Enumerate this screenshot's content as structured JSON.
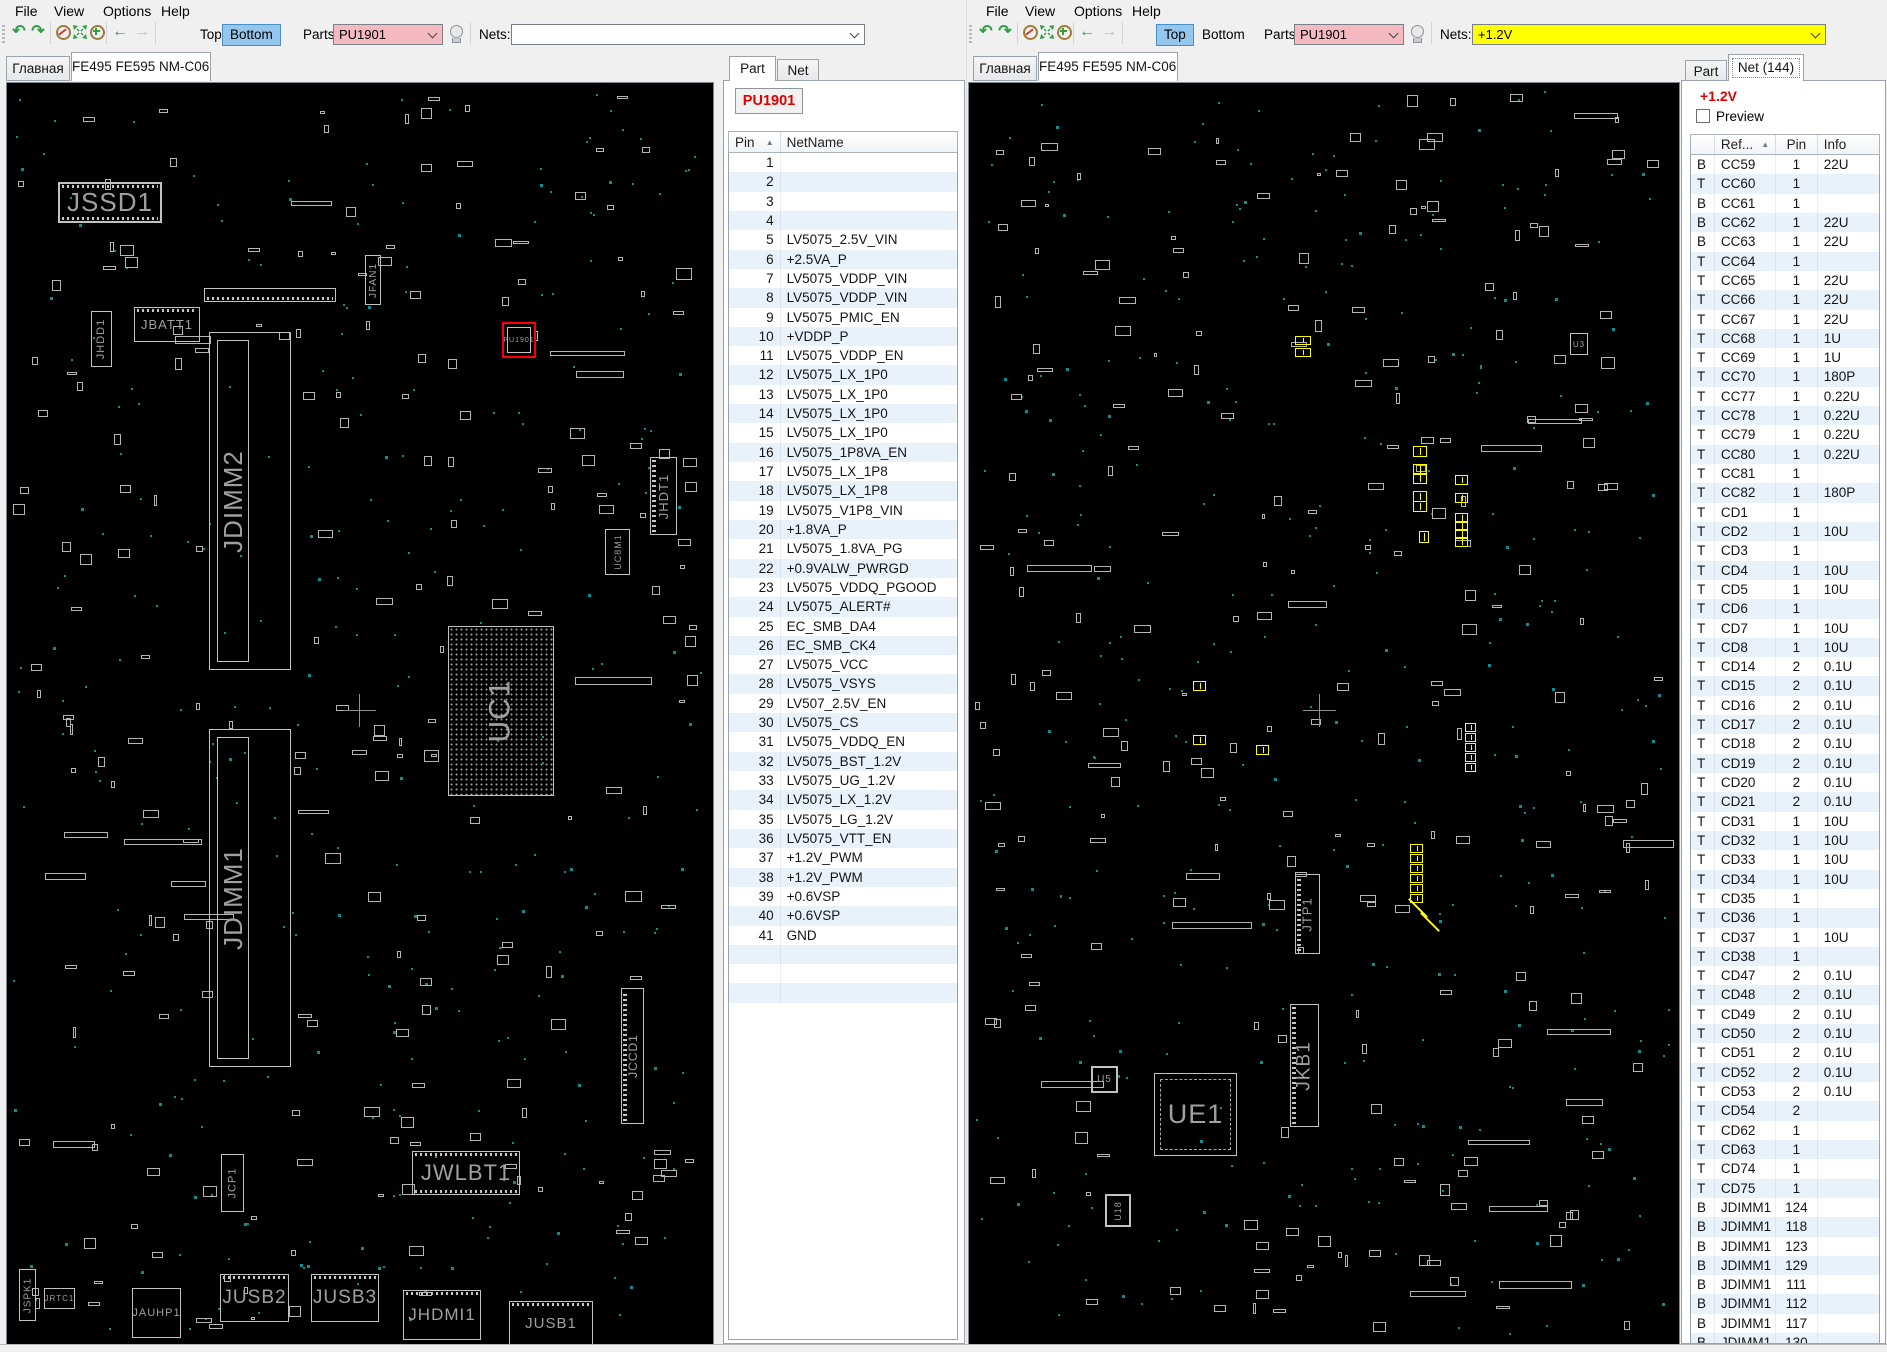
{
  "colors": {
    "selection_blue": "#95c6ee",
    "parts_pink": "#f5b9c2",
    "nets_yellow": "#ffff00",
    "net_red": "#e00000",
    "board_teal": "#0c8f8f",
    "highlight_red": "#ff0000",
    "row_alt": "#e9f1fb"
  },
  "left_window": {
    "menu": [
      "File",
      "View",
      "Options",
      "Help"
    ],
    "toolbar": {
      "top_label": "Top",
      "bottom_label": "Bottom",
      "active_side": "bottom",
      "parts_label": "Parts:",
      "parts_value": "PU1901",
      "nets_label": "Nets:",
      "nets_value": ""
    },
    "tabs": [
      "Главная",
      "FE495 FE595 NM-C061"
    ]
  },
  "right_window": {
    "menu": [
      "File",
      "View",
      "Options",
      "Help"
    ],
    "toolbar": {
      "top_label": "Top",
      "bottom_label": "Bottom",
      "active_side": "top",
      "parts_label": "Parts:",
      "parts_value": "PU1901",
      "nets_label": "Nets:",
      "nets_value": "+1.2V"
    },
    "tabs": [
      "Главная",
      "FE495 FE595 NM-C061"
    ]
  },
  "part_panel": {
    "tabs": [
      "Part",
      "Net"
    ],
    "active_tab": "Part",
    "part_ref": "PU1901",
    "columns": [
      "Pin",
      "NetName"
    ],
    "rows": [
      {
        "pin": "1",
        "net": ""
      },
      {
        "pin": "2",
        "net": ""
      },
      {
        "pin": "3",
        "net": ""
      },
      {
        "pin": "4",
        "net": ""
      },
      {
        "pin": "5",
        "net": "LV5075_2.5V_VIN"
      },
      {
        "pin": "6",
        "net": "+2.5VA_P"
      },
      {
        "pin": "7",
        "net": "LV5075_VDDP_VIN"
      },
      {
        "pin": "8",
        "net": "LV5075_VDDP_VIN"
      },
      {
        "pin": "9",
        "net": "LV5075_PMIC_EN"
      },
      {
        "pin": "10",
        "net": "+VDDP_P"
      },
      {
        "pin": "11",
        "net": "LV5075_VDDP_EN"
      },
      {
        "pin": "12",
        "net": "LV5075_LX_1P0"
      },
      {
        "pin": "13",
        "net": "LV5075_LX_1P0"
      },
      {
        "pin": "14",
        "net": "LV5075_LX_1P0"
      },
      {
        "pin": "15",
        "net": "LV5075_LX_1P0"
      },
      {
        "pin": "16",
        "net": "LV5075_1P8VA_EN"
      },
      {
        "pin": "17",
        "net": "LV5075_LX_1P8"
      },
      {
        "pin": "18",
        "net": "LV5075_LX_1P8"
      },
      {
        "pin": "19",
        "net": "LV5075_V1P8_VIN"
      },
      {
        "pin": "20",
        "net": "+1.8VA_P"
      },
      {
        "pin": "21",
        "net": "LV5075_1.8VA_PG"
      },
      {
        "pin": "22",
        "net": "+0.9VALW_PWRGD"
      },
      {
        "pin": "23",
        "net": "LV5075_VDDQ_PGOOD"
      },
      {
        "pin": "24",
        "net": "LV5075_ALERT#"
      },
      {
        "pin": "25",
        "net": "EC_SMB_DA4"
      },
      {
        "pin": "26",
        "net": "EC_SMB_CK4"
      },
      {
        "pin": "27",
        "net": "LV5075_VCC"
      },
      {
        "pin": "28",
        "net": "LV5075_VSYS"
      },
      {
        "pin": "29",
        "net": "LV507_2.5V_EN"
      },
      {
        "pin": "30",
        "net": "LV5075_CS"
      },
      {
        "pin": "31",
        "net": "LV5075_VDDQ_EN"
      },
      {
        "pin": "32",
        "net": "LV5075_BST_1.2V"
      },
      {
        "pin": "33",
        "net": "LV5075_UG_1.2V"
      },
      {
        "pin": "34",
        "net": "LV5075_LX_1.2V"
      },
      {
        "pin": "35",
        "net": "LV5075_LG_1.2V"
      },
      {
        "pin": "36",
        "net": "LV5075_VTT_EN"
      },
      {
        "pin": "37",
        "net": "+1.2V_PWM"
      },
      {
        "pin": "38",
        "net": "+1.2V_PWM"
      },
      {
        "pin": "39",
        "net": "+0.6VSP"
      },
      {
        "pin": "40",
        "net": "+0.6VSP"
      },
      {
        "pin": "41",
        "net": "GND"
      }
    ]
  },
  "net_panel": {
    "tabs": [
      "Part",
      "Net (144)"
    ],
    "active_tab": "Net (144)",
    "net_name": "+1.2V",
    "preview_label": "Preview",
    "columns": [
      "",
      "Ref...",
      "Pin",
      "Info"
    ],
    "rows": [
      {
        "side": "B",
        "ref": "CC59",
        "pin": "1",
        "info": "22U"
      },
      {
        "side": "T",
        "ref": "CC60",
        "pin": "1",
        "info": ""
      },
      {
        "side": "B",
        "ref": "CC61",
        "pin": "1",
        "info": ""
      },
      {
        "side": "B",
        "ref": "CC62",
        "pin": "1",
        "info": "22U"
      },
      {
        "side": "B",
        "ref": "CC63",
        "pin": "1",
        "info": "22U"
      },
      {
        "side": "T",
        "ref": "CC64",
        "pin": "1",
        "info": ""
      },
      {
        "side": "T",
        "ref": "CC65",
        "pin": "1",
        "info": "22U"
      },
      {
        "side": "T",
        "ref": "CC66",
        "pin": "1",
        "info": "22U"
      },
      {
        "side": "T",
        "ref": "CC67",
        "pin": "1",
        "info": "22U"
      },
      {
        "side": "T",
        "ref": "CC68",
        "pin": "1",
        "info": "1U"
      },
      {
        "side": "T",
        "ref": "CC69",
        "pin": "1",
        "info": "1U"
      },
      {
        "side": "T",
        "ref": "CC70",
        "pin": "1",
        "info": "180P"
      },
      {
        "side": "T",
        "ref": "CC77",
        "pin": "1",
        "info": "0.22U"
      },
      {
        "side": "T",
        "ref": "CC78",
        "pin": "1",
        "info": "0.22U"
      },
      {
        "side": "T",
        "ref": "CC79",
        "pin": "1",
        "info": "0.22U"
      },
      {
        "side": "T",
        "ref": "CC80",
        "pin": "1",
        "info": "0.22U"
      },
      {
        "side": "T",
        "ref": "CC81",
        "pin": "1",
        "info": ""
      },
      {
        "side": "T",
        "ref": "CC82",
        "pin": "1",
        "info": "180P"
      },
      {
        "side": "T",
        "ref": "CD1",
        "pin": "1",
        "info": ""
      },
      {
        "side": "T",
        "ref": "CD2",
        "pin": "1",
        "info": "10U"
      },
      {
        "side": "T",
        "ref": "CD3",
        "pin": "1",
        "info": ""
      },
      {
        "side": "T",
        "ref": "CD4",
        "pin": "1",
        "info": "10U"
      },
      {
        "side": "T",
        "ref": "CD5",
        "pin": "1",
        "info": "10U"
      },
      {
        "side": "T",
        "ref": "CD6",
        "pin": "1",
        "info": ""
      },
      {
        "side": "T",
        "ref": "CD7",
        "pin": "1",
        "info": "10U"
      },
      {
        "side": "T",
        "ref": "CD8",
        "pin": "1",
        "info": "10U"
      },
      {
        "side": "T",
        "ref": "CD14",
        "pin": "2",
        "info": "0.1U"
      },
      {
        "side": "T",
        "ref": "CD15",
        "pin": "2",
        "info": "0.1U"
      },
      {
        "side": "T",
        "ref": "CD16",
        "pin": "2",
        "info": "0.1U"
      },
      {
        "side": "T",
        "ref": "CD17",
        "pin": "2",
        "info": "0.1U"
      },
      {
        "side": "T",
        "ref": "CD18",
        "pin": "2",
        "info": "0.1U"
      },
      {
        "side": "T",
        "ref": "CD19",
        "pin": "2",
        "info": "0.1U"
      },
      {
        "side": "T",
        "ref": "CD20",
        "pin": "2",
        "info": "0.1U"
      },
      {
        "side": "T",
        "ref": "CD21",
        "pin": "2",
        "info": "0.1U"
      },
      {
        "side": "T",
        "ref": "CD31",
        "pin": "1",
        "info": "10U"
      },
      {
        "side": "T",
        "ref": "CD32",
        "pin": "1",
        "info": "10U"
      },
      {
        "side": "T",
        "ref": "CD33",
        "pin": "1",
        "info": "10U"
      },
      {
        "side": "T",
        "ref": "CD34",
        "pin": "1",
        "info": "10U"
      },
      {
        "side": "T",
        "ref": "CD35",
        "pin": "1",
        "info": ""
      },
      {
        "side": "T",
        "ref": "CD36",
        "pin": "1",
        "info": ""
      },
      {
        "side": "T",
        "ref": "CD37",
        "pin": "1",
        "info": "10U"
      },
      {
        "side": "T",
        "ref": "CD38",
        "pin": "1",
        "info": ""
      },
      {
        "side": "T",
        "ref": "CD47",
        "pin": "2",
        "info": "0.1U"
      },
      {
        "side": "T",
        "ref": "CD48",
        "pin": "2",
        "info": "0.1U"
      },
      {
        "side": "T",
        "ref": "CD49",
        "pin": "2",
        "info": "0.1U"
      },
      {
        "side": "T",
        "ref": "CD50",
        "pin": "2",
        "info": "0.1U"
      },
      {
        "side": "T",
        "ref": "CD51",
        "pin": "2",
        "info": "0.1U"
      },
      {
        "side": "T",
        "ref": "CD52",
        "pin": "2",
        "info": "0.1U"
      },
      {
        "side": "T",
        "ref": "CD53",
        "pin": "2",
        "info": "0.1U"
      },
      {
        "side": "T",
        "ref": "CD54",
        "pin": "2",
        "info": ""
      },
      {
        "side": "T",
        "ref": "CD62",
        "pin": "1",
        "info": ""
      },
      {
        "side": "T",
        "ref": "CD63",
        "pin": "1",
        "info": ""
      },
      {
        "side": "T",
        "ref": "CD74",
        "pin": "1",
        "info": ""
      },
      {
        "side": "T",
        "ref": "CD75",
        "pin": "1",
        "info": ""
      },
      {
        "side": "B",
        "ref": "JDIMM1",
        "pin": "124",
        "info": ""
      },
      {
        "side": "B",
        "ref": "JDIMM1",
        "pin": "118",
        "info": ""
      },
      {
        "side": "B",
        "ref": "JDIMM1",
        "pin": "123",
        "info": ""
      },
      {
        "side": "B",
        "ref": "JDIMM1",
        "pin": "129",
        "info": ""
      },
      {
        "side": "B",
        "ref": "JDIMM1",
        "pin": "111",
        "info": ""
      },
      {
        "side": "B",
        "ref": "JDIMM1",
        "pin": "112",
        "info": ""
      },
      {
        "side": "B",
        "ref": "JDIMM1",
        "pin": "117",
        "info": ""
      },
      {
        "side": "B",
        "ref": "JDIMM1",
        "pin": "130",
        "info": ""
      }
    ]
  },
  "left_board": {
    "components": [
      {
        "name": "jssd1",
        "label": "JSSD1",
        "x": 51,
        "y": 99,
        "w": 104,
        "h": 41,
        "fs": 26,
        "orient": "h",
        "pins": "tb",
        "bw": 2
      },
      {
        "name": "jfan1",
        "label": "JFAN1",
        "x": 358,
        "y": 172,
        "w": 16,
        "h": 50,
        "fs": 10,
        "orient": "v"
      },
      {
        "name": "job1",
        "label": "",
        "x": 197,
        "y": 205,
        "w": 132,
        "h": 14,
        "pins": "b"
      },
      {
        "name": "jhdd1",
        "label": "JHDD1",
        "x": 84,
        "y": 228,
        "w": 21,
        "h": 56,
        "fs": 11,
        "orient": "v"
      },
      {
        "name": "jbatt1",
        "label": "JBATT1",
        "x": 127,
        "y": 224,
        "w": 66,
        "h": 35,
        "fs": 13,
        "orient": "h",
        "pins": "t"
      },
      {
        "name": "jdimm2",
        "label": "JDIMM2",
        "x": 202,
        "y": 249,
        "w": 82,
        "h": 338,
        "fs": 26,
        "orient": "v",
        "type": "dimm"
      },
      {
        "name": "jdimm1",
        "label": "JDIMM1",
        "x": 202,
        "y": 646,
        "w": 82,
        "h": 338,
        "fs": 26,
        "orient": "v",
        "type": "dimm"
      },
      {
        "name": "pu1901",
        "label": "PU1901",
        "x": 495,
        "y": 239,
        "w": 34,
        "h": 36,
        "fs": 7,
        "type": "hl"
      },
      {
        "name": "jhdt1",
        "label": "JHDT1",
        "x": 643,
        "y": 374,
        "w": 27,
        "h": 78,
        "fs": 13,
        "orient": "v",
        "pins": "lr"
      },
      {
        "name": "uc8m1",
        "label": "UC8M1",
        "x": 598,
        "y": 446,
        "w": 25,
        "h": 46,
        "fs": 9,
        "orient": "v"
      },
      {
        "name": "uc1",
        "label": "UC1",
        "x": 441,
        "y": 543,
        "w": 106,
        "h": 170,
        "fs": 30,
        "orient": "v",
        "type": "bga"
      },
      {
        "name": "jccd1",
        "label": "JCCD1",
        "x": 614,
        "y": 905,
        "w": 23,
        "h": 136,
        "fs": 12,
        "orient": "v",
        "pins": "lr"
      },
      {
        "name": "jwlbt1",
        "label": "JWLBT1",
        "x": 405,
        "y": 1068,
        "w": 108,
        "h": 44,
        "fs": 22,
        "orient": "h",
        "pins": "tb"
      },
      {
        "name": "jcp1",
        "label": "JCP1",
        "x": 214,
        "y": 1071,
        "w": 23,
        "h": 58,
        "fs": 11,
        "orient": "v"
      },
      {
        "name": "jspk1",
        "label": "JSPK1",
        "x": 12,
        "y": 1186,
        "w": 17,
        "h": 52,
        "fs": 10,
        "orient": "v"
      },
      {
        "name": "jrtc1",
        "label": "JRTC1",
        "x": 37,
        "y": 1205,
        "w": 31,
        "h": 21,
        "fs": 8,
        "orient": "h"
      },
      {
        "name": "jauhp1",
        "label": "JAUHP1",
        "x": 125,
        "y": 1205,
        "w": 49,
        "h": 50,
        "fs": 11,
        "orient": "h"
      },
      {
        "name": "jusb2",
        "label": "JUSB2",
        "x": 213,
        "y": 1191,
        "w": 69,
        "h": 48,
        "fs": 19,
        "orient": "h",
        "pins": "t"
      },
      {
        "name": "jusb3",
        "label": "JUSB3",
        "x": 304,
        "y": 1191,
        "w": 68,
        "h": 48,
        "fs": 19,
        "orient": "h",
        "pins": "t"
      },
      {
        "name": "jhdmi1",
        "label": "JHDMI1",
        "x": 396,
        "y": 1207,
        "w": 78,
        "h": 50,
        "fs": 17,
        "orient": "h",
        "pins": "t"
      },
      {
        "name": "jusb1",
        "label": "JUSB1",
        "x": 502,
        "y": 1218,
        "w": 84,
        "h": 44,
        "fs": 15,
        "orient": "h",
        "pins": "t"
      }
    ],
    "crosshair": {
      "x": 352,
      "y": 627
    }
  },
  "right_board": {
    "components": [
      {
        "name": "u3",
        "label": "U3",
        "x": 601,
        "y": 250,
        "w": 18,
        "h": 22,
        "fs": 8,
        "orient": "h"
      },
      {
        "name": "jtp1",
        "label": "JTP1",
        "x": 326,
        "y": 791,
        "w": 25,
        "h": 80,
        "fs": 13,
        "orient": "v",
        "pins": "lr"
      },
      {
        "name": "jkb1",
        "label": "JKB1",
        "x": 321,
        "y": 921,
        "w": 29,
        "h": 123,
        "fs": 19,
        "orient": "v",
        "pins": "lr"
      },
      {
        "name": "u5",
        "label": "U5",
        "x": 122,
        "y": 983,
        "w": 27,
        "h": 27,
        "fs": 10,
        "orient": "h",
        "bw": 2
      },
      {
        "name": "ue1",
        "label": "UE1",
        "x": 185,
        "y": 990,
        "w": 83,
        "h": 83,
        "fs": 27,
        "orient": "h",
        "type": "qfp"
      },
      {
        "name": "u18",
        "label": "U18",
        "x": 136,
        "y": 1111,
        "w": 26,
        "h": 33,
        "fs": 9,
        "orient": "v",
        "bw": 2
      }
    ],
    "highlight_pads": [
      {
        "x": 326,
        "y": 253,
        "w": 16,
        "h": 9
      },
      {
        "x": 326,
        "y": 265,
        "w": 16,
        "h": 9
      },
      {
        "x": 444,
        "y": 363,
        "w": 14,
        "h": 11
      },
      {
        "x": 444,
        "y": 381,
        "w": 14,
        "h": 11
      },
      {
        "x": 444,
        "y": 390,
        "w": 14,
        "h": 11
      },
      {
        "x": 444,
        "y": 408,
        "w": 14,
        "h": 11
      },
      {
        "x": 444,
        "y": 418,
        "w": 14,
        "h": 11
      },
      {
        "x": 450,
        "y": 448,
        "w": 10,
        "h": 12
      },
      {
        "x": 486,
        "y": 392,
        "w": 13,
        "h": 10
      },
      {
        "x": 486,
        "y": 410,
        "w": 13,
        "h": 10
      },
      {
        "x": 486,
        "y": 430,
        "w": 13,
        "h": 10
      },
      {
        "x": 486,
        "y": 438,
        "w": 13,
        "h": 10
      },
      {
        "x": 486,
        "y": 446,
        "w": 13,
        "h": 10
      },
      {
        "x": 486,
        "y": 454,
        "w": 13,
        "h": 10
      },
      {
        "x": 224,
        "y": 598,
        "w": 13,
        "h": 10
      },
      {
        "x": 224,
        "y": 652,
        "w": 13,
        "h": 10
      },
      {
        "x": 287,
        "y": 662,
        "w": 13,
        "h": 10
      },
      {
        "x": 441,
        "y": 761,
        "w": 13,
        "h": 9
      },
      {
        "x": 441,
        "y": 771,
        "w": 13,
        "h": 9
      },
      {
        "x": 441,
        "y": 781,
        "w": 13,
        "h": 9
      },
      {
        "x": 441,
        "y": 791,
        "w": 13,
        "h": 9
      },
      {
        "x": 441,
        "y": 801,
        "w": 13,
        "h": 9
      },
      {
        "x": 441,
        "y": 811,
        "w": 13,
        "h": 9
      },
      {
        "x": 496,
        "y": 640,
        "w": 11,
        "h": 9
      },
      {
        "x": 496,
        "y": 650,
        "w": 11,
        "h": 9
      },
      {
        "x": 496,
        "y": 660,
        "w": 11,
        "h": 9
      },
      {
        "x": 496,
        "y": 670,
        "w": 11,
        "h": 9
      },
      {
        "x": 496,
        "y": 680,
        "w": 11,
        "h": 9
      }
    ],
    "highlight_diagonals": [
      {
        "x": 436,
        "y": 824,
        "len": 26
      },
      {
        "x": 448,
        "y": 838,
        "len": 26
      }
    ],
    "crosshair": {
      "x": 350,
      "y": 627
    }
  }
}
